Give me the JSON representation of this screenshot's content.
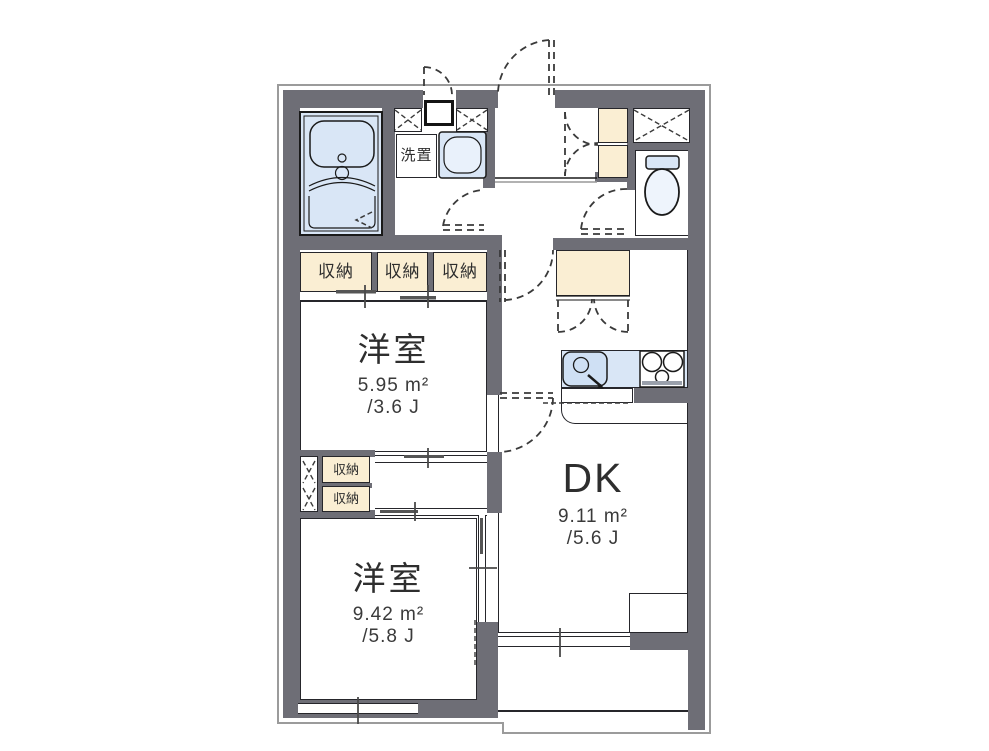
{
  "floorplan": {
    "rooms": [
      {
        "name": "洋室",
        "area_m2": "5.95 m²",
        "area_jo": "/3.6 J"
      },
      {
        "name": "DK",
        "area_m2": "9.11 m²",
        "area_jo": "/5.6 J"
      },
      {
        "name": "洋室",
        "area_m2": "9.42 m²",
        "area_jo": "/5.8 J"
      }
    ],
    "closets": [
      "収納",
      "収納",
      "収納",
      "収納",
      "収納"
    ],
    "washer_space_label": "洗置",
    "colors": {
      "wall": "#6e6e76",
      "water_area": "#d9e6f6",
      "storage": "#faeed3",
      "line": "#1a1a1a"
    }
  }
}
